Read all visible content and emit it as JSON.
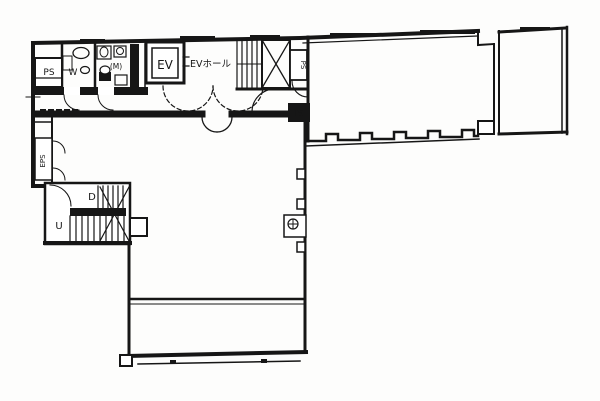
{
  "floor_plan": {
    "labels": {
      "ps_upper_left": "PS",
      "wc_w": "W",
      "wc_m": "(M)",
      "elevator": "EV",
      "ev_hall": "EVホール",
      "ps_upper_right": "PS",
      "ps_mid": "PS",
      "eps": "EPS",
      "stair_down": "D",
      "stair_up": "U"
    },
    "colors": {
      "line": "#161616",
      "background": "#ffffff"
    }
  }
}
